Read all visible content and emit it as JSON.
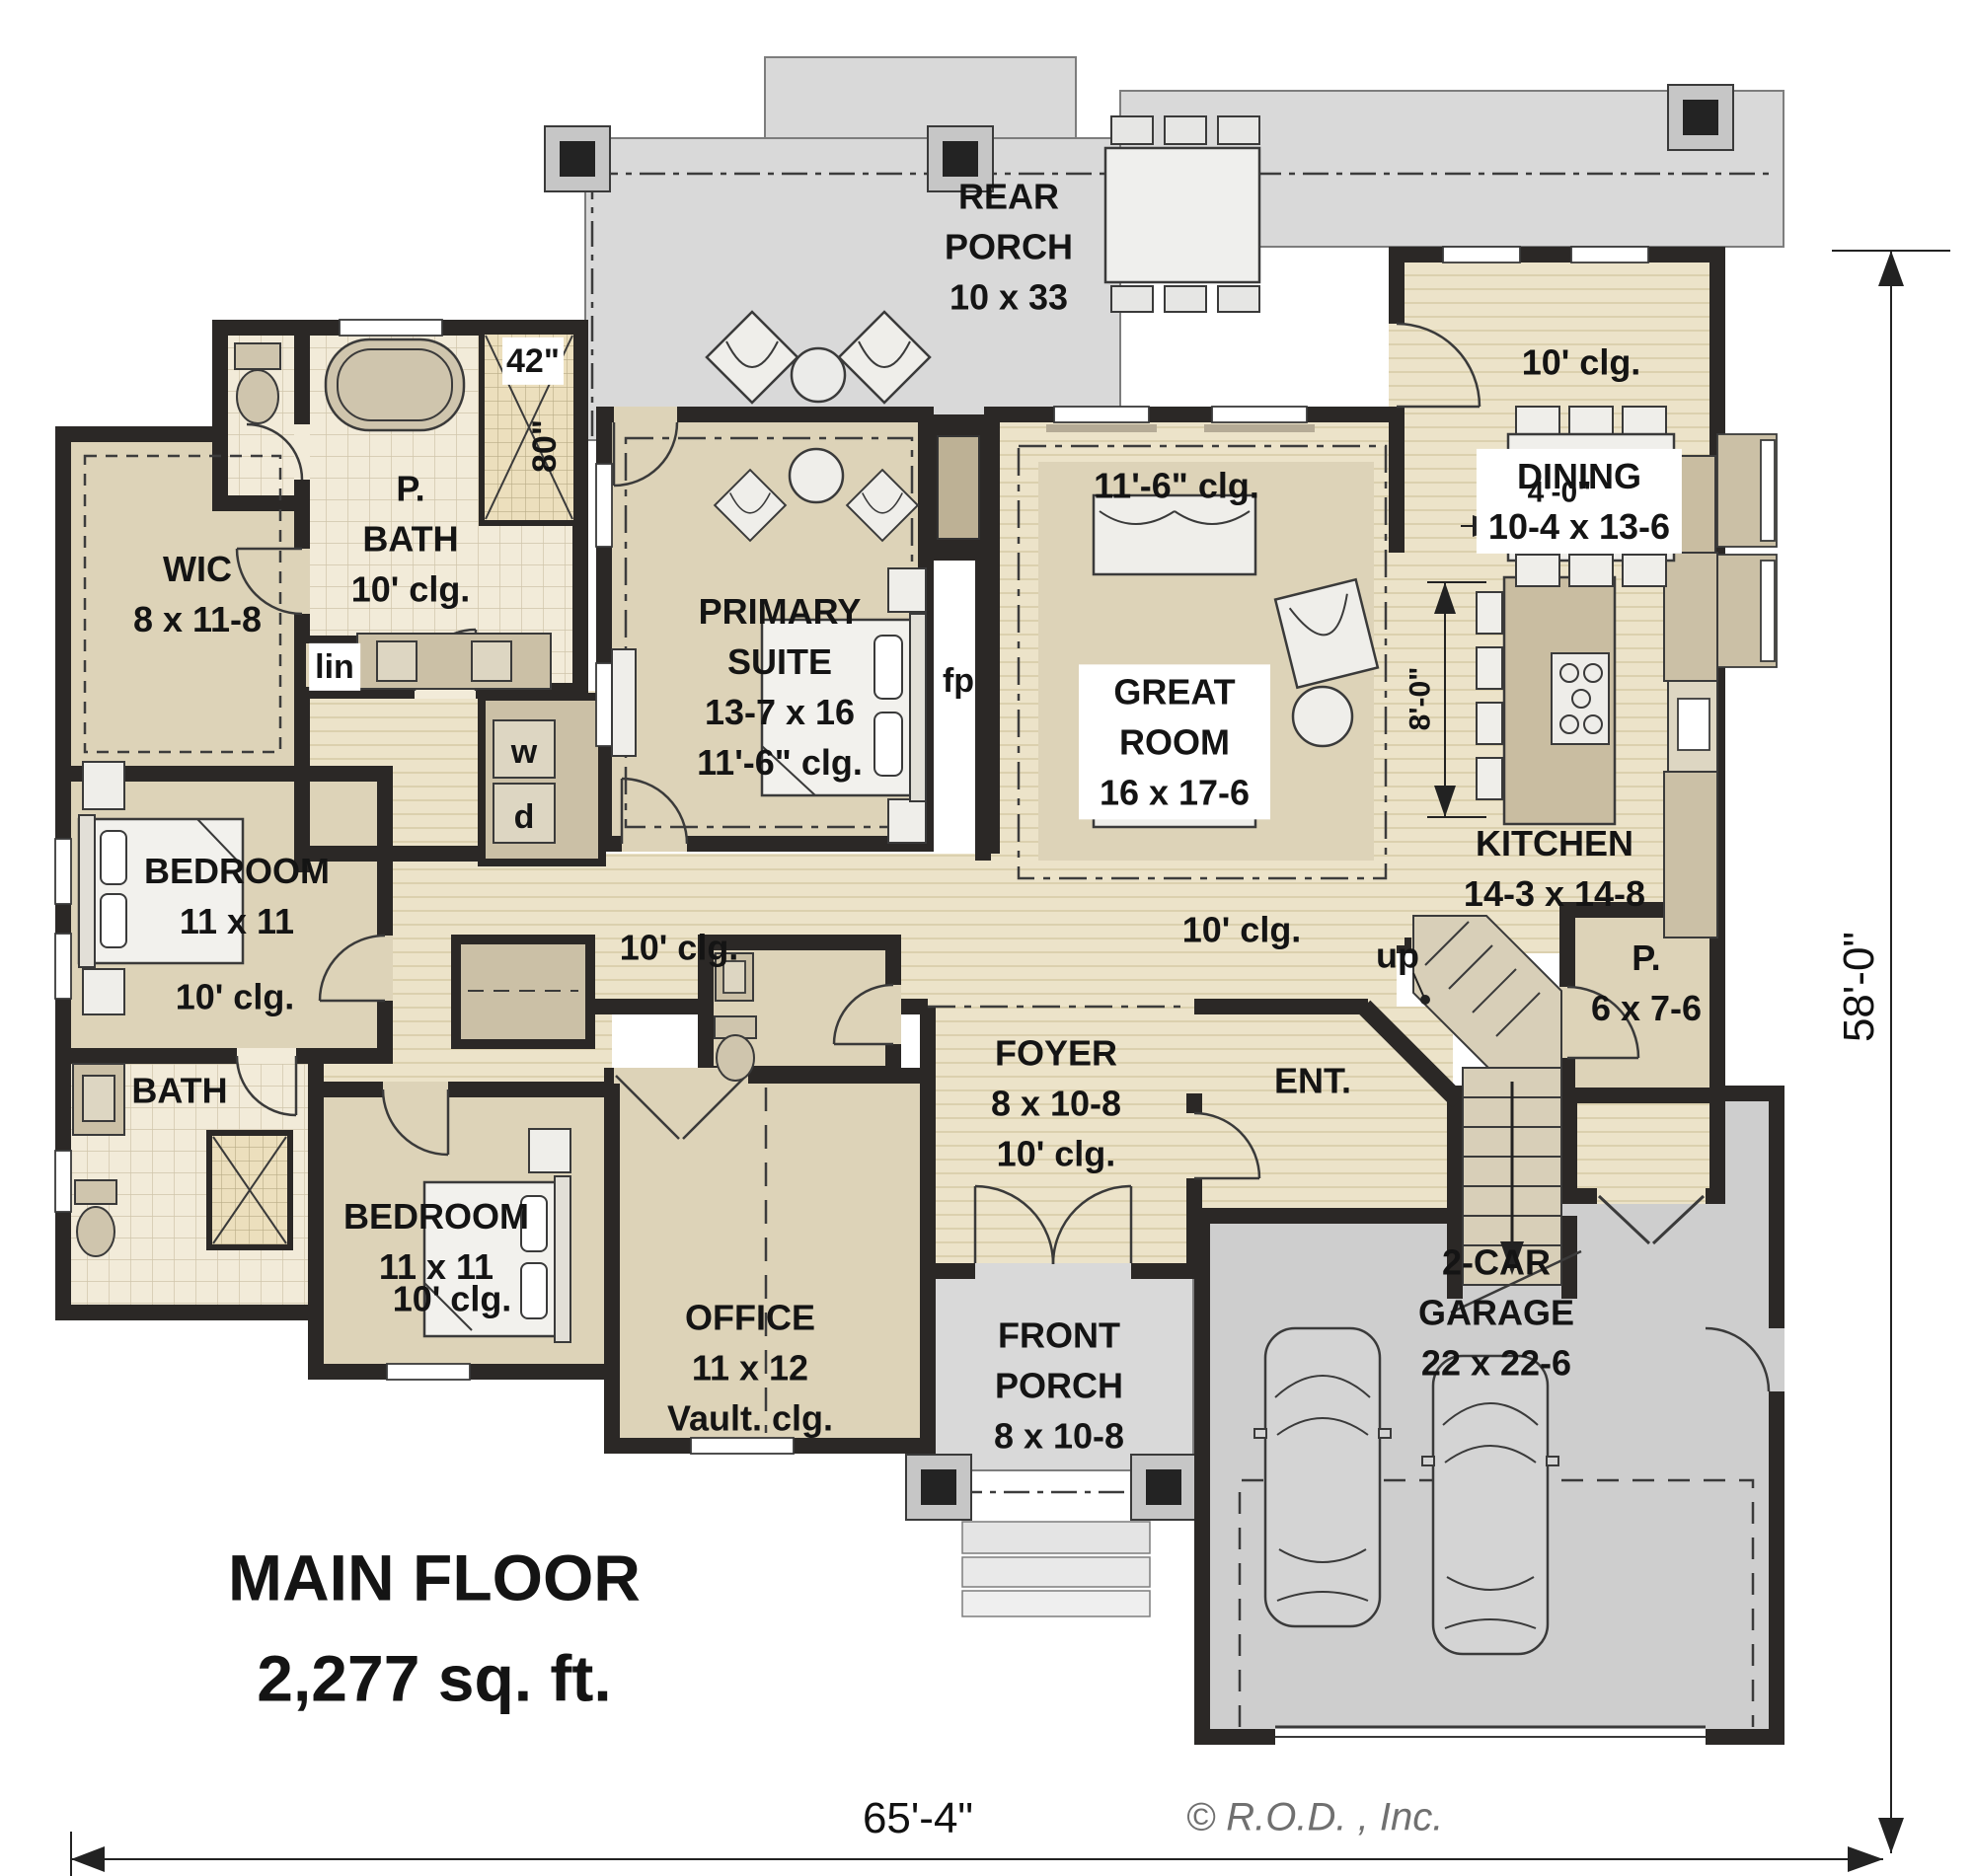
{
  "plan": {
    "title": "MAIN FLOOR",
    "area": "2,277 sq. ft.",
    "width_dim": "65'-4\"",
    "height_dim": "58'-0\"",
    "copyright": "© R.O.D. , Inc."
  },
  "rooms": {
    "rear_porch": {
      "name": "REAR PORCH",
      "dims": "10 x 33"
    },
    "dining": {
      "ceiling": "10' clg.",
      "name": "DINING",
      "dims": "10-4 x 13-6"
    },
    "great_room": {
      "ceiling": "11'-6\" clg.",
      "name": "GREAT ROOM",
      "dims": "16 x 17-6"
    },
    "kitchen": {
      "name": "KITCHEN",
      "dims": "14-3 x 14-8",
      "island_width": "4'-0\"",
      "island_depth": "8'-0\""
    },
    "primary_suite": {
      "name_line1": "PRIMARY",
      "name_line2": "SUITE",
      "dims": "13-7 x 16",
      "ceiling": "11'-6\" clg."
    },
    "p_bath": {
      "name_line1": "P.",
      "name_line2": "BATH",
      "ceiling": "10' clg.",
      "shower_width": "42\"",
      "shower_depth": "80\""
    },
    "wic": {
      "name": "WIC",
      "dims": "8 x 11-8"
    },
    "bedroom_left": {
      "name": "BEDROOM",
      "dims": "11 x 11",
      "ceiling": "10' clg."
    },
    "bath_left": {
      "name": "BATH"
    },
    "bedroom_lower": {
      "name": "BEDROOM",
      "dims": "11 x 11",
      "ceiling": "10' clg."
    },
    "office": {
      "name": "OFFICE",
      "dims": "11 x 12",
      "ceiling": "Vault. clg."
    },
    "foyer": {
      "name": "FOYER",
      "dims": "8 x 10-8",
      "ceiling": "10' clg."
    },
    "ent": {
      "name": "ENT."
    },
    "pantry": {
      "name": "P.",
      "dims": "6 x 7-6"
    },
    "garage": {
      "name_line1": "2-CAR",
      "name_line2": "GARAGE",
      "dims": "22 x 22-6"
    },
    "front_porch": {
      "name_line1": "FRONT",
      "name_line2": "PORCH",
      "dims": "8 x 10-8"
    }
  },
  "annotations": {
    "hall_left_ceiling": "10' clg.",
    "hall_right_ceiling": "10' clg.",
    "stairs_up": "up",
    "fireplace": "fp",
    "washer": "w",
    "dryer": "d",
    "linen": "lin"
  }
}
